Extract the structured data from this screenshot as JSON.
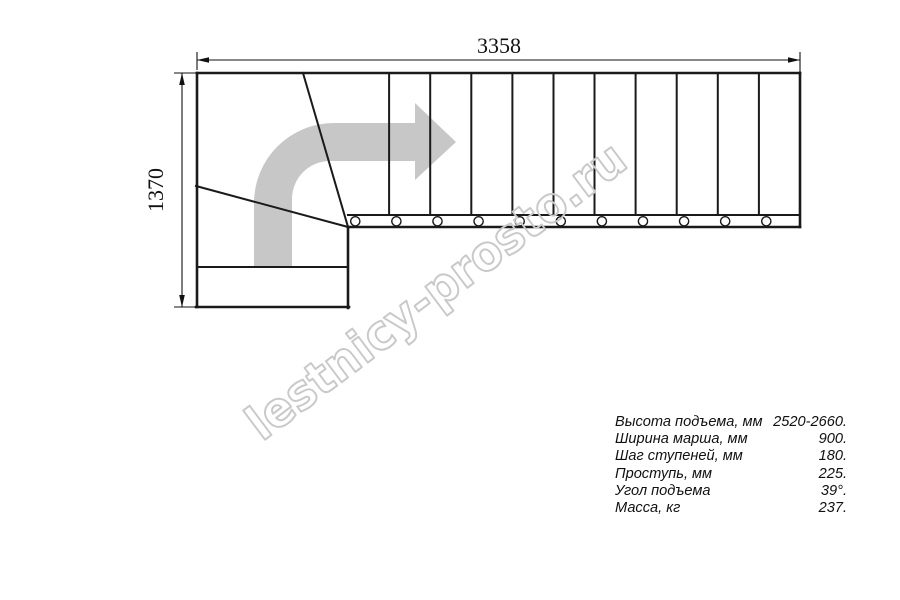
{
  "drawing": {
    "width_dim": "3358",
    "height_dim": "1370"
  },
  "watermark": {
    "text": "lestnicy-prosto.ru"
  },
  "specs": {
    "rows": [
      {
        "label": "Высота подъема, мм",
        "value": "2520-2660."
      },
      {
        "label": "Ширина марша, мм",
        "value": "900."
      },
      {
        "label": "Шаг ступеней, мм",
        "value": "180."
      },
      {
        "label": "Проступь, мм",
        "value": "225."
      },
      {
        "label": "Угол подъема",
        "value": "39°."
      },
      {
        "label": "Масса, кг",
        "value": "237."
      }
    ]
  },
  "colors": {
    "line": "#1a1a1a",
    "dim": "#111111",
    "arrow_fill": "#c7c7c7",
    "watermark": "#c9c9c9"
  }
}
